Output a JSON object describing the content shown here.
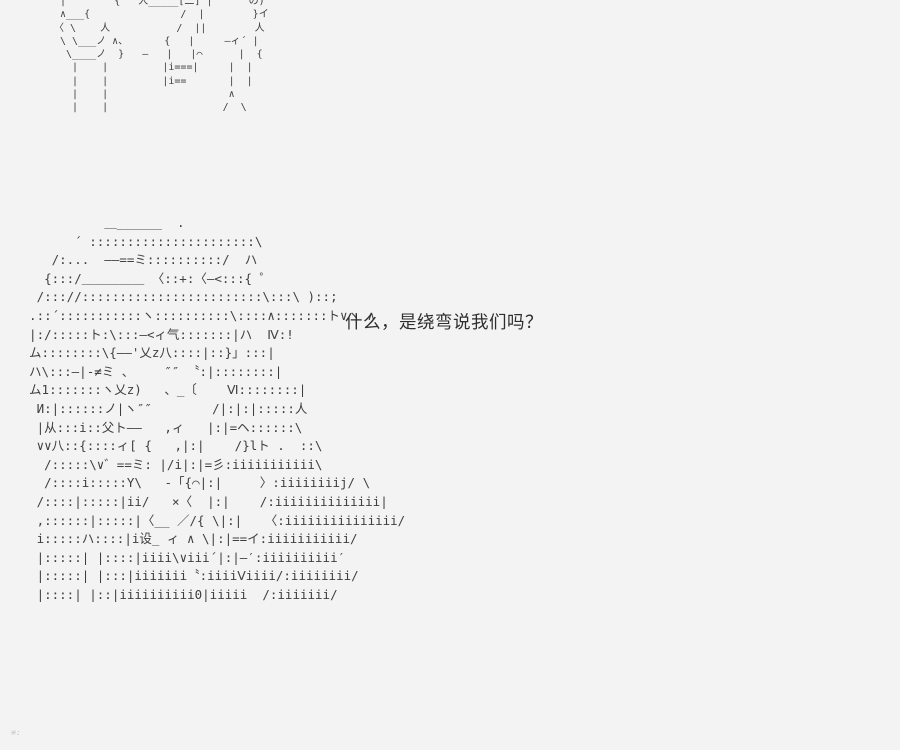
{
  "scene": {
    "background_color": "#f3f3f4",
    "art_color": "#3f3f3f",
    "text_color": "#2e2e2e"
  },
  "dialogue": {
    "text": "什么，是绕弯说我们吗？"
  },
  "art_top": {
    "description": "cropped ascii-art fragment (legs/lower half of figures)",
    "lines": [
      " |        {   人_____[二]¨|      の)",
      " ∧___{               /  |        }イ",
      "〈 \\    人           /  ||        人",
      " \\ \\___ノ ∧、      {   |     ―ィ´ |",
      "  \\____ノ  }   ―   |   |⌒      |  {",
      "   |    |         |i===|     |  |",
      "   |    |         |i==       |  |",
      "   |    |                    ∧",
      "   |    |                   /  \\"
    ]
  },
  "art_main": {
    "description": "ascii-art of long-haired girl character",
    "lines": [
      "            ＿______  .",
      "        ´ ::::::::::::::::::::::\\",
      "     /:...  ――==ミ::::::::::/  ハ",
      "    {:::/＿＿＿＿＿ 〈::+:〈―<:::{ ゜",
      "   /::://::::::::::::::::::::::::\\:::\\ )::;",
      "  .::´:::::::::::ヽ::::::::::\\::::∧:::::::ト∨ヽ ∧",
      "  |:/:::::ト:\\:::―<ィ气:::::::|ハ  Ⅳ:!",
      "  ム::::::::\\{――'乂z八::::|::}」:::|",
      "  ハ\\:::―|-≠ミ 、    ″″ 〝:|::::::::|",
      "  ム1:::::::ヽ乂z)   、_〔    Ⅵ::::::::|",
      "   И:|::::::ノ|ヽ″″        /|:|:|:::::人",
      "   |从:::i::父ト――   ,ィ   |:|=ヘ::::::\\",
      "   ∨∨八::{::::ィ[ {   ,|:|    /}lト .  ::\\",
      "    /:::::\\∨゛==ミ: |/i|:|=彡:iiiiiiiiiii\\",
      "    /::::i:::::Y\\   -「{⌒|:|     〉:iiiiiiiij/ \\",
      "   /::::|:::::|ii/   ×〈  |:|    /:iiiiiiiiiiiiii|",
      "   ,::::::|:::::|〈__ ／/{ \\|:|   〈:iiiiiiiiiiiiiii/",
      "   i:::::ハ::::|i设_ ィ ∧ \\|:|==イ:iiiiiiiiiii/",
      "   |:::::| |::::|iiii\\∨iii´|:|―′:iiiiiiiiii′",
      "   |:::::| |:::|iiiiiii〝:iiiiⅤiiii/:iiiiiiii/",
      "   |::::| |::|iiiiiiiiii0|iiiii  /:iiiiiii/"
    ]
  },
  "corner_artifact": {
    "text": "≡:"
  }
}
